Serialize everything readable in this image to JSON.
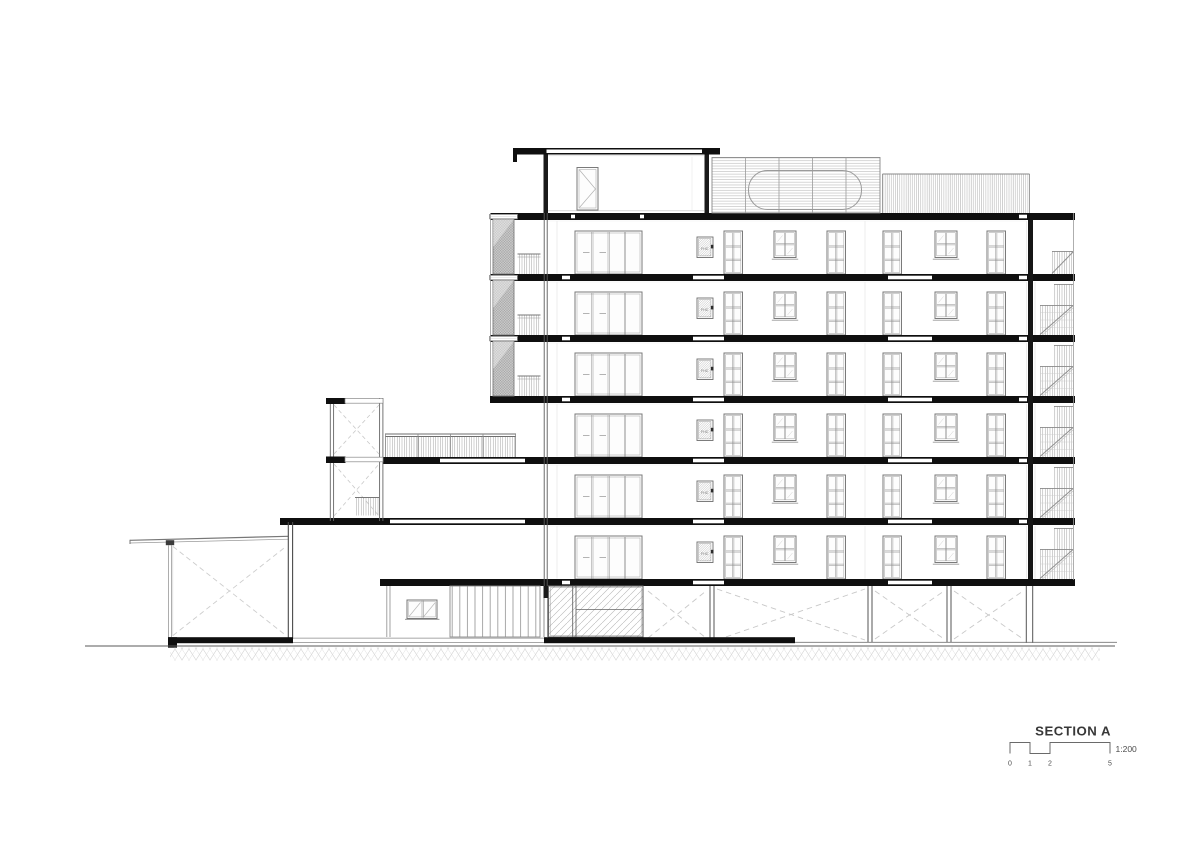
{
  "page": {
    "background": "#ffffff"
  },
  "drawing": {
    "title": "SECTION A",
    "scale": "1:200",
    "scale_ticks": [
      "0",
      "1",
      "2",
      "5"
    ],
    "fhc_label": "FHC",
    "floors_above_ground": 6
  },
  "colors": {
    "poche": "#0f0f0f",
    "cut_wall": "#1a1a1a",
    "heavy_line": "#4a4a4a",
    "medium_line": "#777777",
    "light_line": "#aaaaaa",
    "screen_fill": "#c9c9c9",
    "title_text": "#383838"
  }
}
